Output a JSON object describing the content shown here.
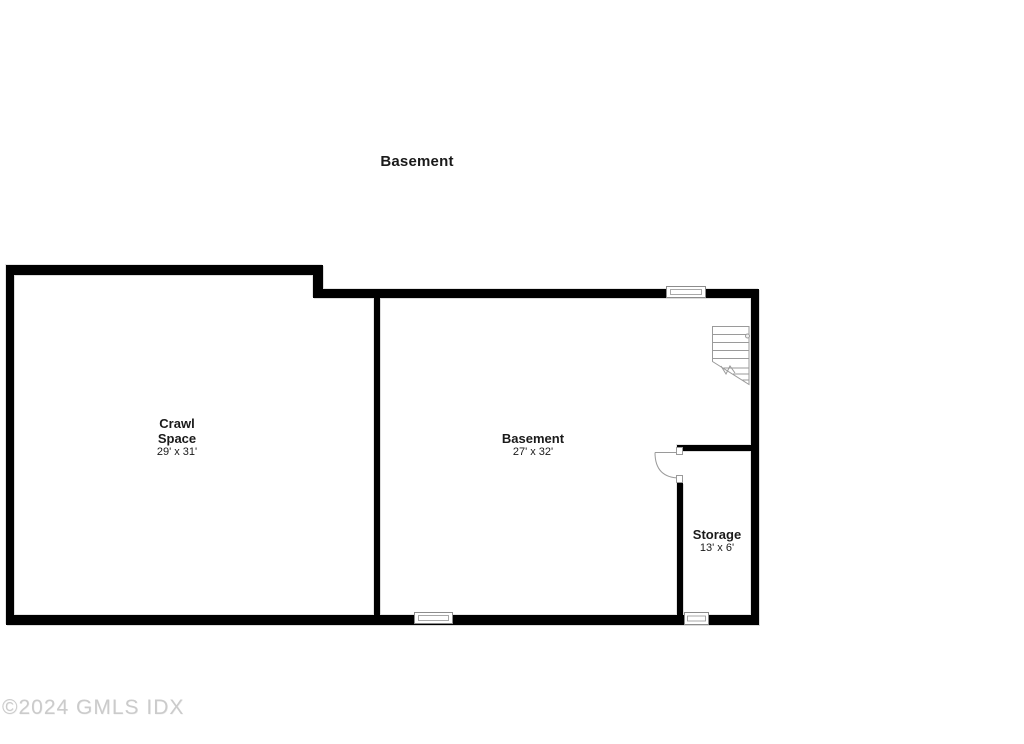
{
  "title": "Basement",
  "rooms": [
    {
      "name": "Crawl Space",
      "dimensions": "29' x 31'"
    },
    {
      "name": "Basement",
      "dimensions": "27' x 32'"
    },
    {
      "name": "Storage",
      "dimensions": "13' x 6'"
    }
  ],
  "watermark": "©2024 GMLS IDX",
  "colors": {
    "background": "#ffffff",
    "wall": "#000000",
    "stair_line": "#9a9a9a",
    "window_line": "#8c8c8c",
    "door_line": "#9a9a9a",
    "text": "#1a1a1a",
    "watermark": "#cbcbcb"
  }
}
